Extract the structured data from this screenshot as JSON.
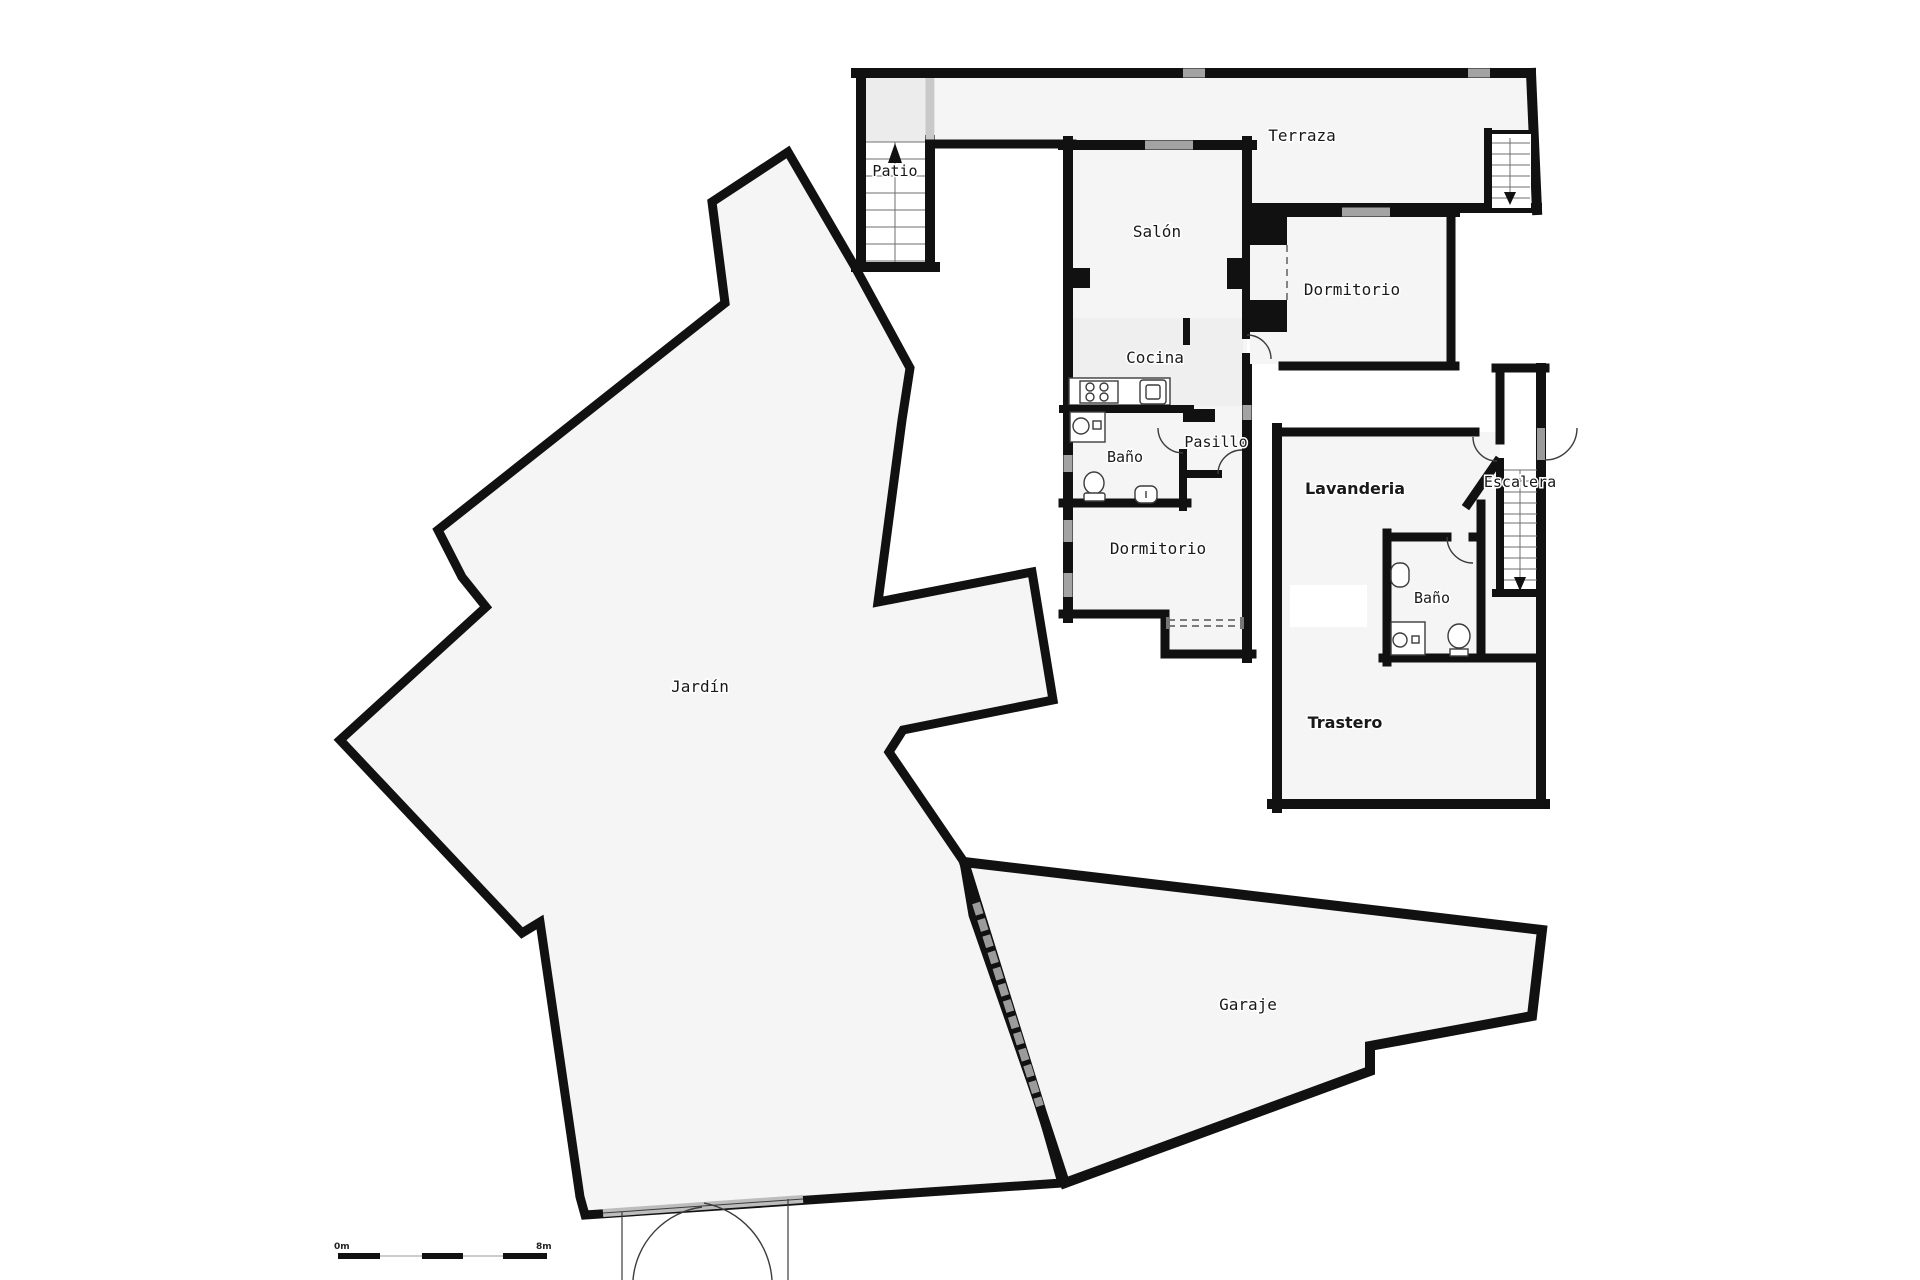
{
  "plan": {
    "rooms": {
      "patio": {
        "label": "Patio"
      },
      "terraza": {
        "label": "Terraza"
      },
      "salon": {
        "label": "Salón"
      },
      "dormitorio_superior": {
        "label": "Dormitorio"
      },
      "cocina": {
        "label": "Cocina"
      },
      "bano_central": {
        "label": "Baño"
      },
      "pasillo": {
        "label": "Pasillo"
      },
      "dormitorio_central": {
        "label": "Dormitorio"
      },
      "lavanderia": {
        "label": "Lavanderia"
      },
      "escalera": {
        "label": "Escalera"
      },
      "bano_derecho": {
        "label": "Baño"
      },
      "trastero": {
        "label": "Trastero"
      },
      "jardin": {
        "label": "Jardín"
      },
      "garaje": {
        "label": "Garaje"
      }
    },
    "scale_bar": {
      "start_label": "0m",
      "end_label": "8m"
    },
    "colors": {
      "wall": "#111111",
      "room_fill": "#f5f5f5",
      "window": "#a3a3a3",
      "background": "#ffffff"
    }
  }
}
